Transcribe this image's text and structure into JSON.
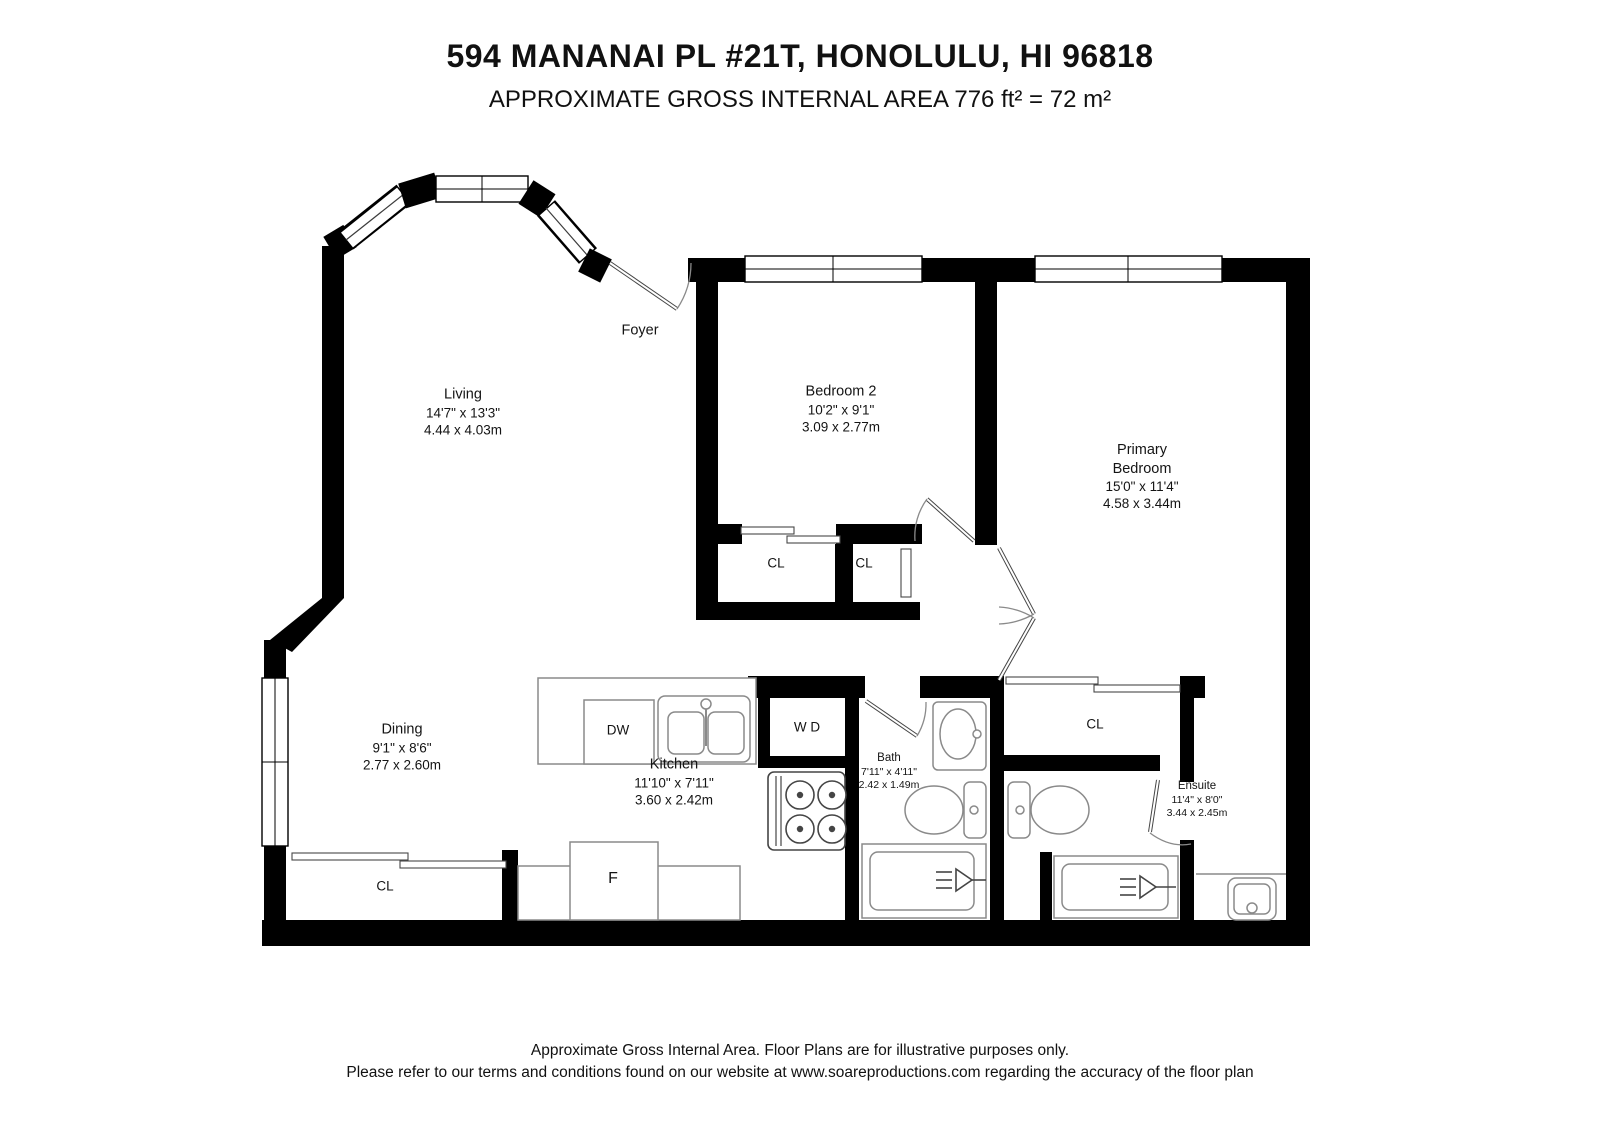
{
  "header": {
    "title": "594 MANANAI PL #21T, HONOLULU, HI 96818",
    "subtitle": "APPROXIMATE GROSS INTERNAL AREA 776 ft² = 72 m²"
  },
  "rooms": {
    "foyer": {
      "name": "Foyer"
    },
    "living": {
      "name": "Living",
      "dims_ft": "14'7\" x 13'3\"",
      "dims_m": "4.44 x 4.03m"
    },
    "bedroom2": {
      "name": "Bedroom 2",
      "dims_ft": "10'2\" x 9'1\"",
      "dims_m": "3.09 x 2.77m"
    },
    "primary": {
      "name_line1": "Primary",
      "name_line2": "Bedroom",
      "dims_ft": "15'0\" x 11'4\"",
      "dims_m": "4.58 x 3.44m"
    },
    "dining": {
      "name": "Dining",
      "dims_ft": "9'1\" x 8'6\"",
      "dims_m": "2.77 x 2.60m"
    },
    "kitchen": {
      "name": "Kitchen",
      "dims_ft": "11'10\" x 7'11\"",
      "dims_m": "3.60 x 2.42m"
    },
    "bath": {
      "name": "Bath",
      "dims_ft": "7'11\" x 4'11\"",
      "dims_m": "2.42 x 1.49m"
    },
    "ensuite": {
      "name": "Ensuite",
      "dims_ft": "11'4\" x 8'0\"",
      "dims_m": "3.44 x 2.45m"
    }
  },
  "labels": {
    "closet": "CL",
    "washer_dryer": "W D",
    "dishwasher": "DW",
    "fridge": "F"
  },
  "footer": {
    "line1": "Approximate Gross Internal Area. Floor Plans are for illustrative purposes only.",
    "line2": "Please refer to our terms and conditions found on our website at www.soareproductions.com regarding the accuracy of the floor plan"
  },
  "colors": {
    "wall": "#000000",
    "fixture_line": "#8a8a8a",
    "text": "#141414"
  }
}
